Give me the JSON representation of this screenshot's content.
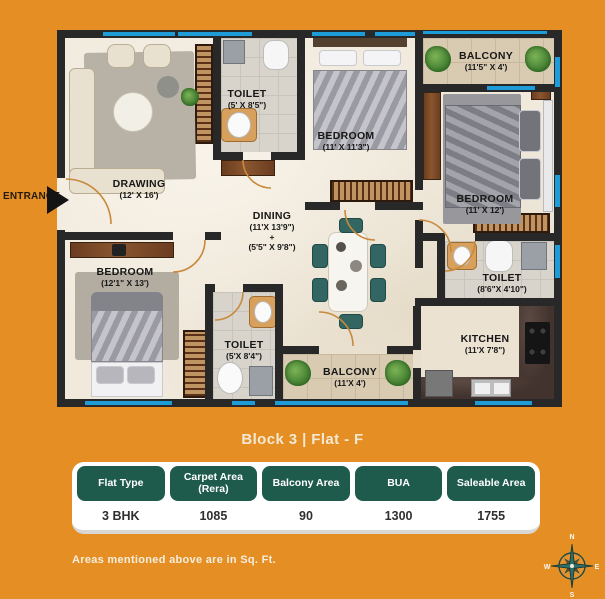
{
  "title": "Block 3 | Flat - F",
  "note": "Areas mentioned above are in Sq. Ft.",
  "entrance": "ENTRANCE",
  "rooms": {
    "drawing": {
      "name": "DRAWING",
      "dims": "(12' X 16')"
    },
    "toilet_top": {
      "name": "TOILET",
      "dims": "(5' X 8'5\")"
    },
    "bedroom_top": {
      "name": "BEDROOM",
      "dims": "(11' X 11'3\")"
    },
    "balcony_top": {
      "name": "BALCONY",
      "dims": "(11'5\" X 4')"
    },
    "bedroom_right": {
      "name": "BEDROOM",
      "dims": "(11' X 12')"
    },
    "dining": {
      "name": "DINING",
      "dims1": "(11'X 13'9\")",
      "plus": "+",
      "dims2": "(5'5\" X 9'8\")"
    },
    "bedroom_left": {
      "name": "BEDROOM",
      "dims": "(12'1\" X 13')"
    },
    "toilet_bottom": {
      "name": "TOILET",
      "dims": "(5'X 8'4\")"
    },
    "balcony_bottom": {
      "name": "BALCONY",
      "dims": "(11'X 4')"
    },
    "toilet_right": {
      "name": "TOILET",
      "dims": "(8'6\"X 4'10\")"
    },
    "kitchen": {
      "name": "KITCHEN",
      "dims": "(11'X 7'8\")"
    }
  },
  "table": {
    "headers": [
      "Flat Type",
      "Carpet Area (Rera)",
      "Balcony Area",
      "BUA",
      "Saleable Area"
    ],
    "values": [
      "3 BHK",
      "1085",
      "90",
      "1300",
      "1755"
    ]
  },
  "compass": {
    "n": "N",
    "e": "E",
    "s": "S",
    "w": "W"
  },
  "colors": {
    "background": "#E58E24",
    "header_green": "#1E5B4D",
    "window_blue": "#1E9CD8",
    "wall": "#282828",
    "floor": "#F0E9DC",
    "title_text": "#F2E9D4"
  }
}
